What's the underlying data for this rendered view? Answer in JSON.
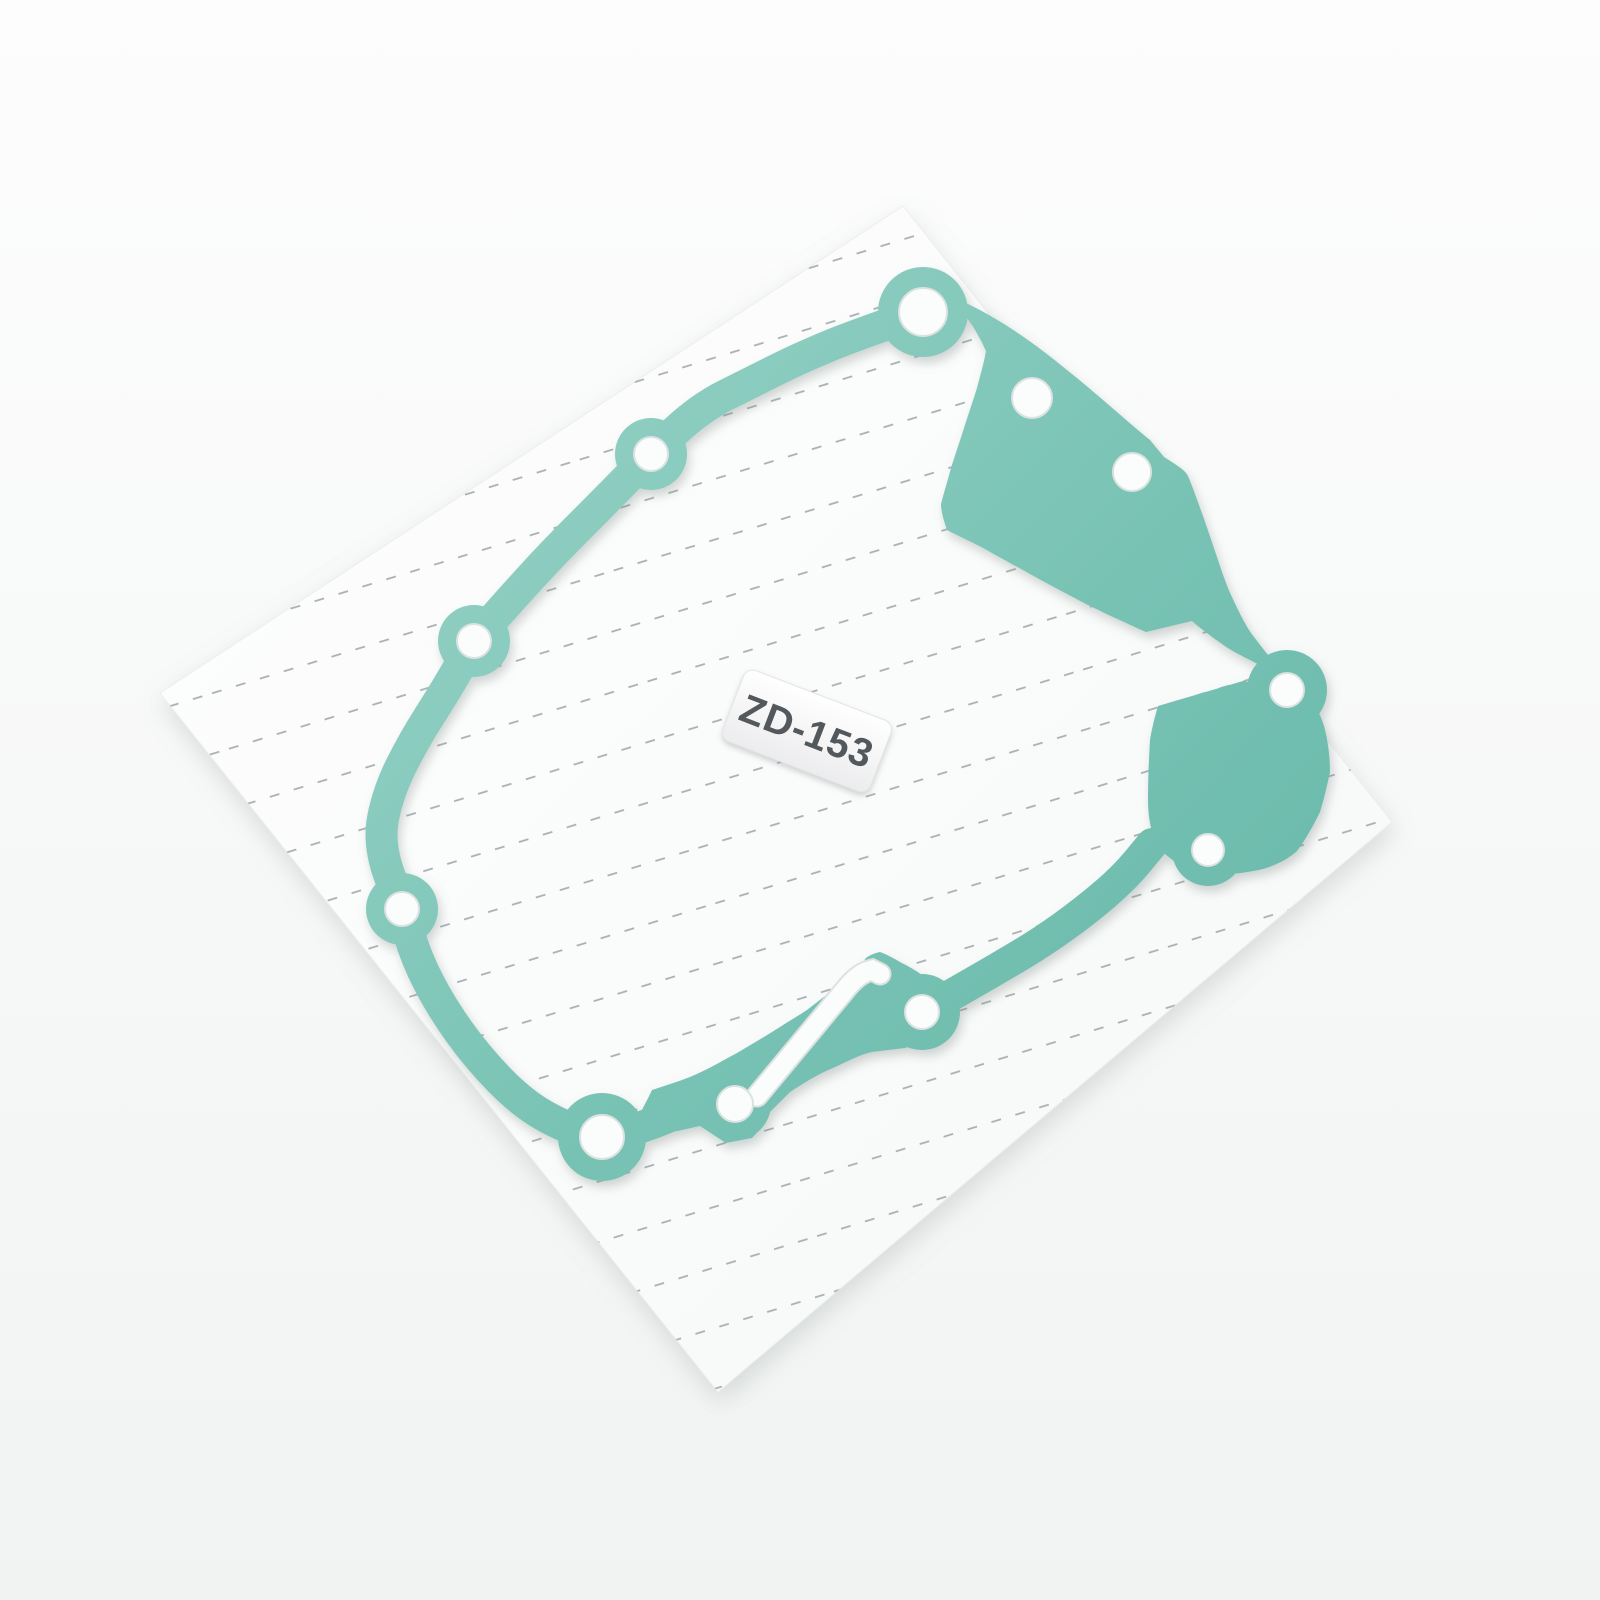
{
  "product_label": {
    "text": "ZD-153"
  },
  "colors": {
    "background_top": "#fdfdfd",
    "background_bottom": "#f1f3f3",
    "backing_sheet": "#fefefe",
    "backing_sheet_shade": "#f6f8f8",
    "perforation_dash": "#a9aeb1",
    "gasket_teal_light": "#98d3c7",
    "gasket_teal": "#7bc4b6",
    "gasket_teal_dark": "#66b8a9",
    "hole_fill": "#fbfcfc",
    "hole_rim": "#dce2e1",
    "label_text": "#53585c"
  }
}
